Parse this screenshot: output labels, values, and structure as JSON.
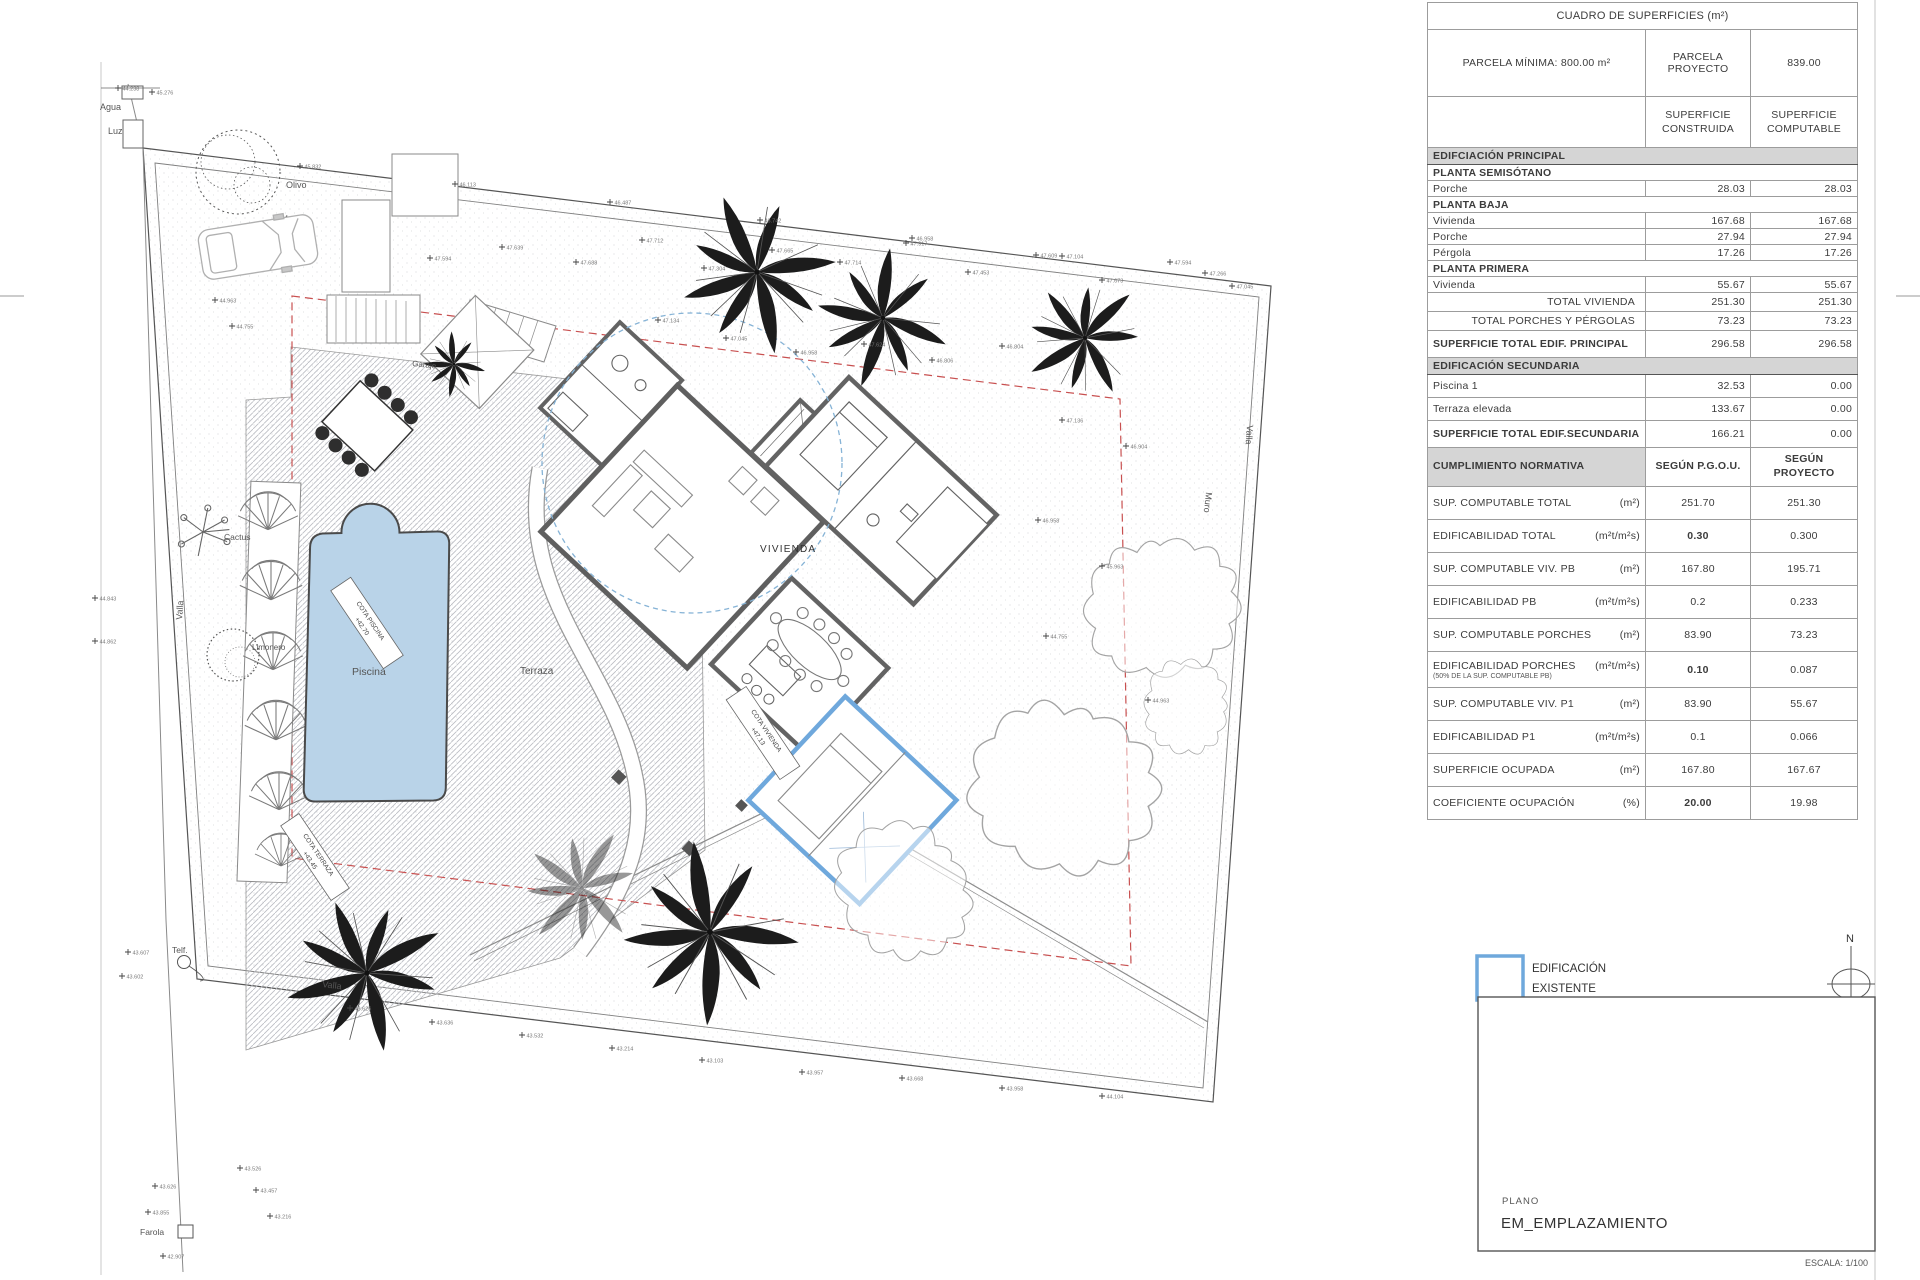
{
  "surface_table": {
    "title": "CUADRO DE SUPERFICIES   (m²)",
    "parcela": {
      "label": "PARCELA MÍNIMA: 800.00 m²",
      "col2a": "PARCELA",
      "col2b": "PROYECTO",
      "value": "839.00"
    },
    "cols": {
      "c1a": "SUPERFICIE",
      "c1b": "CONSTRUIDA",
      "c2a": "SUPERFICIE",
      "c2b": "COMPUTABLE"
    },
    "rows": [
      {
        "label": "EDIFCIACIÓN PRINCIPAL"
      },
      {
        "label": "PLANTA SEMISÓTANO"
      },
      {
        "label": "Porche",
        "v1": "28.03",
        "v2": "28.03"
      },
      {
        "label": "PLANTA BAJA"
      },
      {
        "label": "Vivienda",
        "v1": "167.68",
        "v2": "167.68"
      },
      {
        "label": "Porche",
        "v1": "27.94",
        "v2": "27.94"
      },
      {
        "label": "Pérgola",
        "v1": "17.26",
        "v2": "17.26"
      },
      {
        "label": "PLANTA PRIMERA"
      },
      {
        "label": "Vivienda",
        "v1": "55.67",
        "v2": "55.67"
      },
      {
        "label": "TOTAL VIVIENDA",
        "v1": "251.30",
        "v2": "251.30"
      },
      {
        "label": "TOTAL PORCHES Y PÉRGOLAS",
        "v1": "73.23",
        "v2": "73.23"
      },
      {
        "label": "SUPERFICIE TOTAL EDIF. PRINCIPAL",
        "v1": "296.58",
        "v2": "296.58"
      },
      {
        "label": "EDIFICACIÓN SECUNDARIA"
      },
      {
        "label": "Piscina 1",
        "v1": "32.53",
        "v2": "0.00"
      },
      {
        "label": "Terraza elevada",
        "v1": "133.67",
        "v2": "0.00"
      },
      {
        "label": "SUPERFICIE TOTAL EDIF.SECUNDARIA",
        "v1": "166.21",
        "v2": "0.00"
      },
      {
        "label": "CUMPLIMIENTO NORMATIVA",
        "v1": "SEGÚN P.G.O.U.",
        "v2a": "SEGÚN",
        "v2b": "PROYECTO"
      },
      {
        "label": "SUP. COMPUTABLE TOTAL",
        "unit": "(m²)",
        "v1": "251.70",
        "v2": "251.30"
      },
      {
        "label": "EDIFICABILIDAD TOTAL",
        "unit": "(m²t/m²s)",
        "v1": "0.30",
        "v2": "0.300"
      },
      {
        "label": "SUP. COMPUTABLE VIV. PB",
        "unit": "(m²)",
        "v1": "167.80",
        "v2": "195.71"
      },
      {
        "label": "EDIFICABILIDAD PB",
        "unit": "(m²t/m²s)",
        "v1": "0.2",
        "v2": "0.233"
      },
      {
        "label": "SUP. COMPUTABLE PORCHES",
        "unit": "(m²)",
        "v1": "83.90",
        "v2": "73.23"
      },
      {
        "label": "EDIFICABILIDAD PORCHES",
        "unit": "(m²t/m²s)",
        "sub": "(50% DE  LA SUP. COMPUTABLE PB)",
        "v1": "0.10",
        "v2": "0.087"
      },
      {
        "label": "SUP. COMPUTABLE VIV. P1",
        "unit": "(m²)",
        "v1": "83.90",
        "v2": "55.67"
      },
      {
        "label": "EDIFICABILIDAD P1",
        "unit": "(m²t/m²s)",
        "v1": "0.1",
        "v2": "0.066"
      },
      {
        "label": "SUPERFICIE OCUPADA",
        "unit": "(m²)",
        "v1": "167.80",
        "v2": "167.67"
      },
      {
        "label": "COEFICIENTE OCUPACIÓN",
        "unit": "(%)",
        "v1": "20.00",
        "v2": "19.98"
      }
    ]
  },
  "legend": {
    "line1": "EDIFICACIÓN",
    "line2": "EXISTENTE"
  },
  "north": {
    "label": "N"
  },
  "titleblock": {
    "plano_label": "PLANO",
    "plano_value": "EM_EMPLAZAMIENTO",
    "escala": "ESCALA: 1/100"
  },
  "colors": {
    "existing_blue": "#6fa8dc",
    "pool_fill": "#b9d3e8",
    "setback_red": "#c85050"
  },
  "plan": {
    "labels": {
      "agua": "Agua",
      "luz": "Luz",
      "olivo": "Olivo",
      "muro_top": "Muro",
      "muro_right": "Muro",
      "valla_left": "Valla",
      "valla_bottom": "Valla",
      "valla_right": "Valla",
      "cactus": "Cactus",
      "limonero": "Limonero",
      "terraza": "Terraza",
      "piscina": "Piscina",
      "vivienda": "VIVIENDA",
      "garaje": "Garaje",
      "telf": "Telf.",
      "farola": "Farola"
    },
    "cotas": {
      "piscina_1": "COTA PISCINA",
      "piscina_2": "+42.70",
      "terraza_1": "COTA TERRAZA",
      "terraza_2": "+43.45",
      "vivienda_1": "COTA VIVIENDA",
      "vivienda_2": "+47.13"
    },
    "elevation_markers": [
      [
        300,
        166,
        "45.832"
      ],
      [
        455,
        184,
        "46.113"
      ],
      [
        610,
        202,
        "46.487"
      ],
      [
        760,
        220,
        "46.742"
      ],
      [
        912,
        238,
        "46.958"
      ],
      [
        1062,
        256,
        "47.104"
      ],
      [
        1205,
        273,
        "47.266"
      ],
      [
        430,
        258,
        "47.594"
      ],
      [
        502,
        247,
        "47.639"
      ],
      [
        576,
        262,
        "47.688"
      ],
      [
        642,
        240,
        "47.712"
      ],
      [
        704,
        268,
        "47.304"
      ],
      [
        772,
        250,
        "47.665"
      ],
      [
        840,
        262,
        "47.714"
      ],
      [
        906,
        243,
        "47.917"
      ],
      [
        968,
        272,
        "47.453"
      ],
      [
        1036,
        255,
        "47.609"
      ],
      [
        1102,
        280,
        "47.673"
      ],
      [
        1170,
        262,
        "47.594"
      ],
      [
        1232,
        286,
        "47.045"
      ],
      [
        658,
        320,
        "47.134"
      ],
      [
        726,
        338,
        "47.045"
      ],
      [
        796,
        352,
        "46.958"
      ],
      [
        864,
        344,
        "47.624"
      ],
      [
        932,
        360,
        "46.806"
      ],
      [
        1002,
        346,
        "46.804"
      ],
      [
        1062,
        420,
        "47.136"
      ],
      [
        1126,
        446,
        "46.904"
      ],
      [
        1038,
        520,
        "46.958"
      ],
      [
        1102,
        566,
        "45.963"
      ],
      [
        1046,
        636,
        "44.755"
      ],
      [
        1148,
        700,
        "44.963"
      ],
      [
        350,
        1008,
        "43.626"
      ],
      [
        432,
        1022,
        "43.636"
      ],
      [
        522,
        1035,
        "43.532"
      ],
      [
        612,
        1048,
        "43.214"
      ],
      [
        702,
        1060,
        "43.103"
      ],
      [
        802,
        1072,
        "43.957"
      ],
      [
        902,
        1078,
        "43.668"
      ],
      [
        1002,
        1088,
        "43.958"
      ],
      [
        1102,
        1096,
        "44.104"
      ],
      [
        95,
        598,
        "44.843"
      ],
      [
        95,
        641,
        "44.862"
      ],
      [
        128,
        952,
        "43.607"
      ],
      [
        122,
        976,
        "43.602"
      ],
      [
        155,
        1186,
        "43.626"
      ],
      [
        148,
        1212,
        "43.855"
      ],
      [
        163,
        1256,
        "42.907"
      ],
      [
        118,
        88,
        "44.238"
      ],
      [
        152,
        92,
        "45.276"
      ],
      [
        215,
        300,
        "44.963"
      ],
      [
        232,
        326,
        "44.755"
      ],
      [
        240,
        1168,
        "43.526"
      ],
      [
        256,
        1190,
        "43.457"
      ],
      [
        270,
        1216,
        "43.216"
      ]
    ]
  }
}
